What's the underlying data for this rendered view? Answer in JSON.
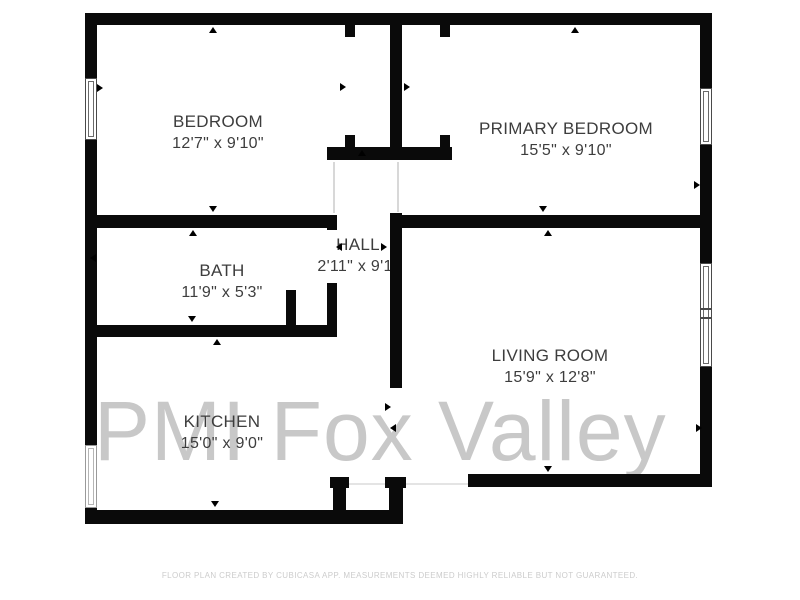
{
  "watermark": "PMI Fox Valley",
  "footer": "FLOOR PLAN CREATED BY CUBICASA APP. MEASUREMENTS DEEMED HIGHLY RELIABLE BUT NOT GUARANTEED.",
  "rooms": {
    "bedroom": {
      "name": "BEDROOM",
      "dims": "12'7\" x 9'10\""
    },
    "primary_bedroom": {
      "name": "PRIMARY BEDROOM",
      "dims": "15'5\" x 9'10\""
    },
    "bath": {
      "name": "BATH",
      "dims": "11'9\" x 5'3\""
    },
    "hall": {
      "name": "HALL",
      "dims": "2'11\" x 9'1\""
    },
    "living_room": {
      "name": "LIVING ROOM",
      "dims": "15'9\" x 12'8\""
    },
    "kitchen": {
      "name": "KITCHEN",
      "dims": "15'0\" x 9'0\""
    }
  },
  "colors": {
    "background": "#ffffff",
    "wall": "#0a0a0a",
    "label_text": "#3d3d3d",
    "watermark_text": "#c8c8c8",
    "footer_text": "#cccccc"
  }
}
